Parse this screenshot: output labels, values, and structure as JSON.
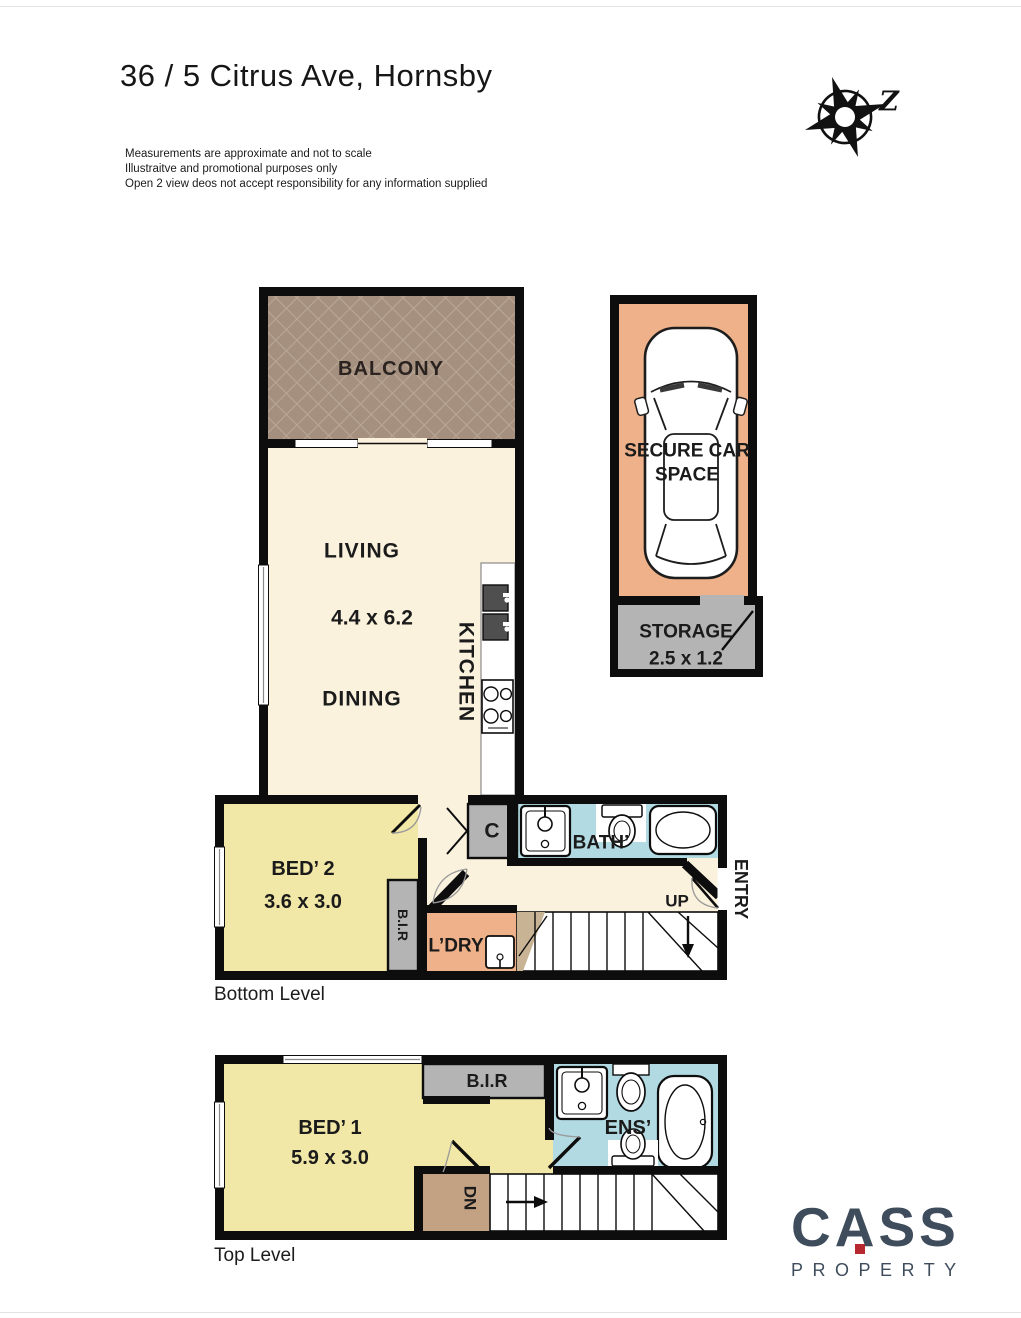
{
  "header": {
    "title": "36 / 5 Citrus Ave, Hornsby",
    "disclaimer": [
      "Measurements are approximate and not to scale",
      "Illustraitve and promotional purposes only",
      "Open 2 view deos not accept responsibility for any information supplied"
    ],
    "compass_letter": "Z"
  },
  "bottom_level": {
    "caption": "Bottom Level",
    "balcony": "BALCONY",
    "living": "LIVING",
    "living_dimensions": "4.4 x 6.2",
    "dining": "DINING",
    "kitchen": "KITCHEN",
    "bed2": "BED’ 2",
    "bed2_dimensions": "3.6 x 3.0",
    "bir": "B.I.R",
    "laundry": "L’DRY",
    "cupboard": "C",
    "bath": "BATH’",
    "stairs_direction": "UP",
    "entry": "ENTRY"
  },
  "parking": {
    "car_space": "SECURE CAR SPACE",
    "storage": "STORAGE",
    "storage_dimensions": "2.5 x 1.2"
  },
  "top_level": {
    "caption": "Top Level",
    "bed1": "BED’ 1",
    "bed1_dimensions": "5.9 x 3.0",
    "bir": "B.I.R",
    "ensuite": "ENS’",
    "stairs_direction": "DN"
  },
  "branding": {
    "logo_text": "CASS",
    "logo_subtext": "PROPERTY"
  },
  "colors": {
    "cream": "#fbf2dd",
    "bedroom_yellow": "#f1e7a6",
    "bath_blue": "#b2dae2",
    "salmon": "#eeb189",
    "unit_gray": "#b4b4b4",
    "balcony_brown": "#a5907f",
    "wall_black": "#0d0d0d",
    "logo_navy": "#3e4c5c",
    "logo_red": "#b7282f"
  }
}
